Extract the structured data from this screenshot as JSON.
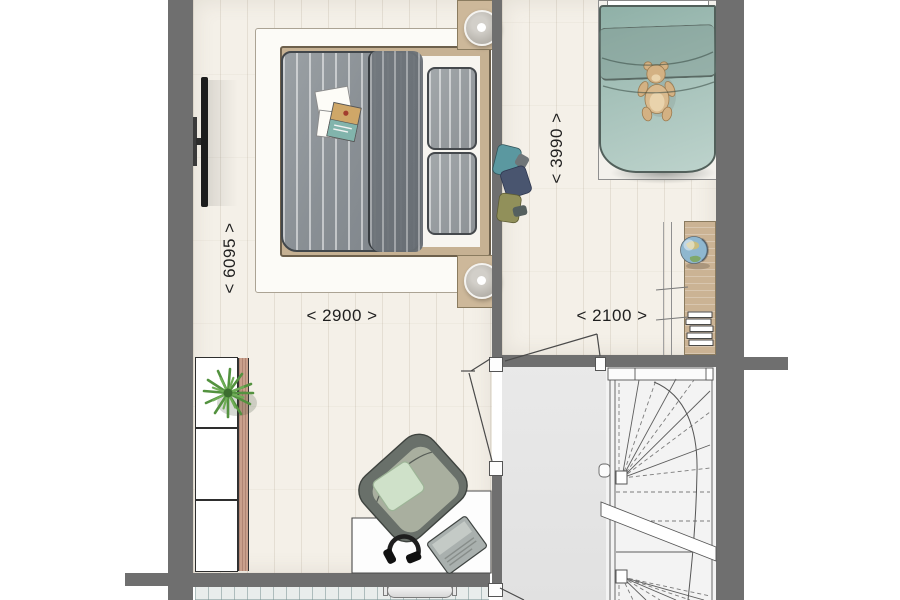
{
  "floorplan": {
    "type": "architectural floor plan, first floor with two bedrooms and winder staircase",
    "dimension_labels": {
      "left_room_depth": "< 6095 >",
      "left_room_width": "< 2900 >",
      "right_room_depth": "< 3990 >",
      "right_room_width": "< 2100 >"
    },
    "rooms": [
      {
        "name": "bedroom-left",
        "width_label": "< 2900 >",
        "depth_label": "< 6095 >"
      },
      {
        "name": "bedroom-right",
        "width_label": "< 2100 >",
        "depth_label": "< 3990 >"
      },
      {
        "name": "landing"
      },
      {
        "name": "staircase-well"
      },
      {
        "name": "bathroom-strip-bottom"
      }
    ],
    "furniture_icons": [
      "tv-icon",
      "double-bed-icon",
      "nightstand-lamp-icon",
      "magazines-icon",
      "shelf-unit-icon",
      "plant-icon",
      "desk-icon",
      "lounge-chair-icon",
      "headphones-icon",
      "laptop-icon",
      "single-bed-icon",
      "teddy-bear-icon",
      "clothes-pile-icon",
      "kids-desk-icon",
      "globe-icon",
      "book-stack-icon",
      "radiator-icon",
      "winder-stair-icon",
      "door-swing-icon"
    ],
    "colors": {
      "wall": "#6f6f6f",
      "wood_floor": "#f4f0e8",
      "landing_floor": "#e6e6e6",
      "stair_floor": "#f3f3f3",
      "tiles": "#e9edec",
      "duvet_gray": "#8d9296",
      "duvet_teal": "#a9c3bb",
      "furniture_wood": "#cbb394",
      "mint_pillow": "#cfe1c9",
      "label_text": "#1f1f1f"
    }
  }
}
